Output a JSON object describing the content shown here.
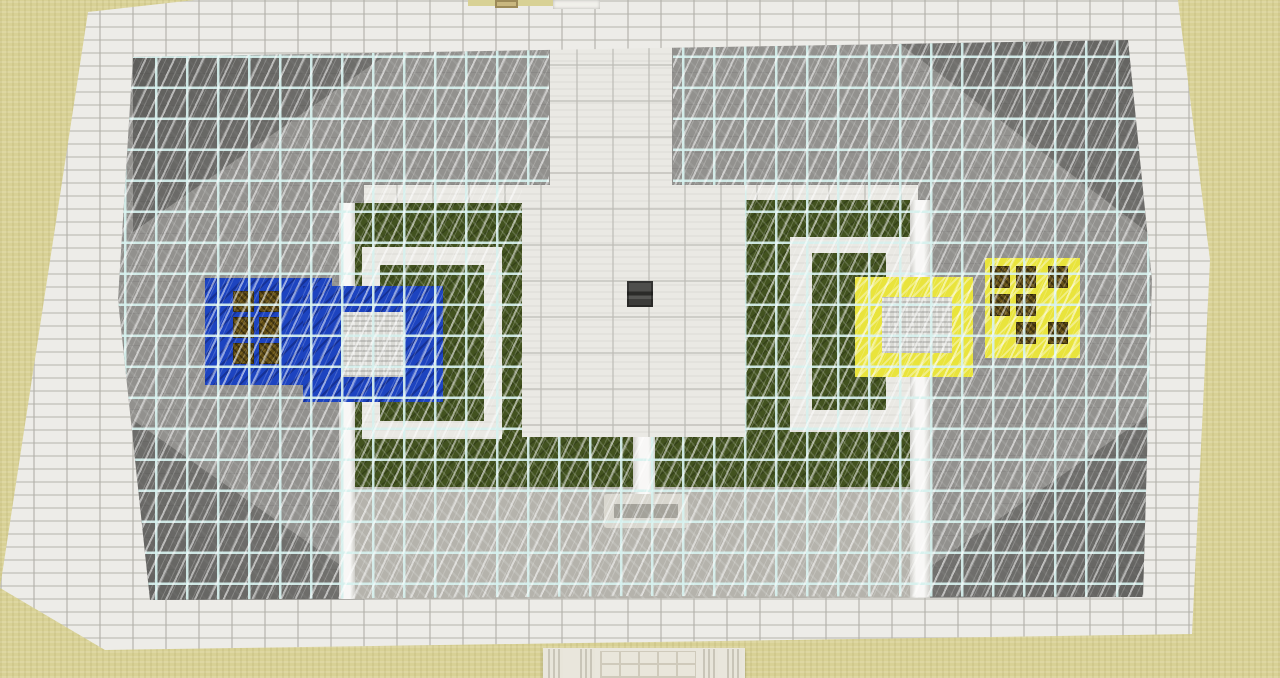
{
  "scene": {
    "title": "Minecraft top-down arena with glass roof",
    "type": "game-screenshot",
    "ground": "sand",
    "team_bases": [
      {
        "side": "left",
        "color_name": "blue"
      },
      {
        "side": "right",
        "color_name": "yellow"
      }
    ],
    "glass_roof": {
      "cell_px": 31,
      "zones": [
        "left",
        "right"
      ],
      "open_areas": [
        "central-corridor",
        "central-plaza"
      ]
    },
    "colors": {
      "sand": "#d8d195",
      "quartz-band": "#edece8",
      "quartz-floor": "#eae9e4",
      "stone-gray": "#92918e",
      "stone-light": "#b5b3ac",
      "grass-green": "#42521f",
      "team-blue": "#1d44c0",
      "team-yellow": "#e9e43c",
      "iron-white": "#d9d9d4",
      "chest-brown": "#5f4c16",
      "dark-block": "#4a4a48",
      "glass-frame": "#d9f2ef",
      "pole-tan": "#c9b77f",
      "entrance": "#e9e6dc"
    }
  },
  "regions": {
    "inner": [
      {
        "name": "stone-floor-left",
        "kind": "stone",
        "x": 118,
        "y": 45,
        "w": 246,
        "h": 557
      },
      {
        "name": "stone-floor-left-top",
        "kind": "stone",
        "x": 360,
        "y": 40,
        "w": 190,
        "h": 145
      },
      {
        "name": "stone-floor-right",
        "kind": "stone",
        "x": 918,
        "y": 38,
        "w": 248,
        "h": 562
      },
      {
        "name": "stone-floor-right-top",
        "kind": "stone",
        "x": 672,
        "y": 40,
        "w": 248,
        "h": 145
      },
      {
        "name": "wall-shade-top-left",
        "kind": "shade-tl",
        "x": 133,
        "y": 57,
        "w": 250,
        "h": 175
      },
      {
        "name": "wall-shade-bottom-left",
        "kind": "shade-bl",
        "x": 133,
        "y": 420,
        "w": 260,
        "h": 182
      },
      {
        "name": "wall-shade-top-right",
        "kind": "shade-tr",
        "x": 895,
        "y": 40,
        "w": 260,
        "h": 198
      },
      {
        "name": "wall-shade-bottom-right",
        "kind": "shade-br",
        "x": 885,
        "y": 412,
        "w": 268,
        "h": 186
      },
      {
        "name": "stone-light-bottom-strip",
        "kind": "stone-light",
        "x": 350,
        "y": 487,
        "w": 580,
        "h": 112
      },
      {
        "name": "grass-field-left",
        "kind": "grass",
        "x": 350,
        "y": 203,
        "w": 172,
        "h": 284
      },
      {
        "name": "grass-arm-left",
        "kind": "grass",
        "x": 522,
        "y": 437,
        "w": 111,
        "h": 50
      },
      {
        "name": "grass-field-right",
        "kind": "grass",
        "x": 745,
        "y": 200,
        "w": 165,
        "h": 287
      },
      {
        "name": "grass-arm-right",
        "kind": "grass",
        "x": 655,
        "y": 437,
        "w": 90,
        "h": 50
      },
      {
        "name": "quartz-ring-left",
        "kind": "quartz-path",
        "x": 362,
        "y": 247,
        "w": 140,
        "h": 192
      },
      {
        "name": "grass-ring-center-left",
        "kind": "grass",
        "x": 380,
        "y": 265,
        "w": 104,
        "h": 156
      },
      {
        "name": "quartz-ring-right",
        "kind": "quartz-path",
        "x": 790,
        "y": 237,
        "w": 120,
        "h": 195
      },
      {
        "name": "grass-ring-center-right",
        "kind": "grass",
        "x": 812,
        "y": 253,
        "w": 74,
        "h": 157
      },
      {
        "name": "pillar-strip-left",
        "kind": "pillar",
        "x": 339,
        "y": 203,
        "w": 16,
        "h": 396
      },
      {
        "name": "pillar-strip-right",
        "kind": "pillar",
        "x": 910,
        "y": 200,
        "w": 20,
        "h": 399
      },
      {
        "name": "pillar-strip-center",
        "kind": "pillar",
        "x": 633,
        "y": 437,
        "w": 22,
        "h": 58
      },
      {
        "name": "fountain-structure",
        "kind": "fountain",
        "x": 604,
        "y": 494,
        "w": 84,
        "h": 34
      },
      {
        "name": "blue-supply-pad",
        "kind": "team-blue",
        "x": 205,
        "y": 278,
        "w": 127,
        "h": 107
      },
      {
        "name": "supply-block-blue-1",
        "kind": "chest",
        "x": 233,
        "y": 291,
        "w": 21,
        "h": 21
      },
      {
        "name": "supply-block-blue-2",
        "kind": "chest",
        "x": 259,
        "y": 291,
        "w": 21,
        "h": 21
      },
      {
        "name": "supply-block-blue-3",
        "kind": "chest",
        "x": 233,
        "y": 317,
        "w": 21,
        "h": 21
      },
      {
        "name": "supply-block-blue-4",
        "kind": "chest",
        "x": 259,
        "y": 317,
        "w": 21,
        "h": 21
      },
      {
        "name": "supply-block-blue-5",
        "kind": "chest",
        "x": 233,
        "y": 343,
        "w": 21,
        "h": 21
      },
      {
        "name": "supply-block-blue-6",
        "kind": "chest",
        "x": 259,
        "y": 343,
        "w": 21,
        "h": 21
      },
      {
        "name": "blue-spawn-ring",
        "kind": "team-blue",
        "x": 303,
        "y": 286,
        "w": 140,
        "h": 116
      },
      {
        "name": "iron-center-blue",
        "kind": "iron",
        "x": 341,
        "y": 312,
        "w": 63,
        "h": 65
      },
      {
        "name": "yellow-spawn-ring",
        "kind": "team-yellow",
        "x": 855,
        "y": 277,
        "w": 118,
        "h": 100
      },
      {
        "name": "iron-center-yellow",
        "kind": "iron",
        "x": 882,
        "y": 297,
        "w": 70,
        "h": 56
      },
      {
        "name": "yellow-supply-pad",
        "kind": "team-yellow",
        "x": 985,
        "y": 258,
        "w": 95,
        "h": 100
      },
      {
        "name": "supply-block-yellow-1",
        "kind": "chest",
        "x": 990,
        "y": 266,
        "w": 20,
        "h": 22
      },
      {
        "name": "supply-block-yellow-2",
        "kind": "chest",
        "x": 1016,
        "y": 266,
        "w": 20,
        "h": 22
      },
      {
        "name": "supply-block-yellow-3",
        "kind": "chest",
        "x": 1048,
        "y": 266,
        "w": 20,
        "h": 22
      },
      {
        "name": "supply-block-yellow-4",
        "kind": "chest",
        "x": 990,
        "y": 294,
        "w": 20,
        "h": 22
      },
      {
        "name": "supply-block-yellow-5",
        "kind": "chest",
        "x": 1016,
        "y": 294,
        "w": 20,
        "h": 22
      },
      {
        "name": "supply-block-yellow-6",
        "kind": "chest",
        "x": 1016,
        "y": 322,
        "w": 20,
        "h": 22
      },
      {
        "name": "supply-block-yellow-7",
        "kind": "chest",
        "x": 1048,
        "y": 322,
        "w": 20,
        "h": 22
      },
      {
        "name": "center-anvil-block",
        "kind": "dark-block",
        "x": 627,
        "y": 281,
        "w": 26,
        "h": 26
      }
    ],
    "outer": [
      {
        "name": "sand-notch-top",
        "kind": "sand-patch",
        "x": 468,
        "y": 0,
        "w": 88,
        "h": 6
      },
      {
        "name": "roof-pole-tan",
        "kind": "pole-tan",
        "x": 495,
        "y": 0,
        "w": 23,
        "h": 8
      },
      {
        "name": "roof-pole-white",
        "kind": "pole-white",
        "x": 553,
        "y": 0,
        "w": 47,
        "h": 9
      },
      {
        "name": "entrance-wall",
        "kind": "entrance",
        "x": 543,
        "y": 648,
        "w": 202,
        "h": 30
      },
      {
        "name": "entrance-column-1",
        "kind": "column",
        "x": 548,
        "y": 649,
        "w": 15,
        "h": 29
      },
      {
        "name": "entrance-column-2",
        "kind": "column",
        "x": 580,
        "y": 649,
        "w": 15,
        "h": 29
      },
      {
        "name": "entrance-chiseled-wall",
        "kind": "chiseled",
        "x": 600,
        "y": 651,
        "w": 96,
        "h": 27
      },
      {
        "name": "entrance-column-3",
        "kind": "column",
        "x": 703,
        "y": 649,
        "w": 15,
        "h": 29
      },
      {
        "name": "entrance-column-4",
        "kind": "column",
        "x": 727,
        "y": 649,
        "w": 15,
        "h": 29
      }
    ]
  }
}
